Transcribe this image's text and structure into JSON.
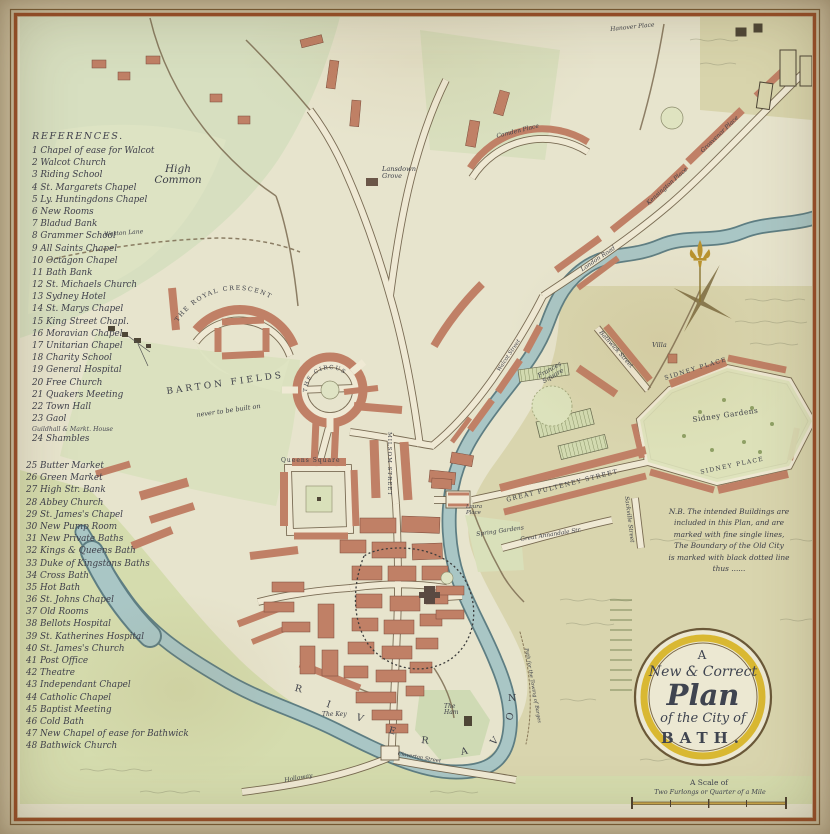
{
  "title_cartouche": {
    "word_a": "A",
    "line_new_correct": "New & Correct",
    "word_plan": "Plan",
    "line_city": "of the City of",
    "word_bath": "BATH."
  },
  "scale": {
    "caption": "A Scale of",
    "subcaption": "Two Furlongs or Quarter of a Mile"
  },
  "note": {
    "text": "N.B. The intended Buildings are\nincluded in this Plan, and are\nmarked with fine single lines,\nThe Boundary of the Old City\nis marked with black dotted line\nthus ......"
  },
  "references": {
    "title": "REFERENCES.",
    "block1": [
      "1 Chapel of ease for Walcot",
      "2 Walcot Church",
      "3 Riding School",
      "4 St. Margarets Chapel",
      "5 Ly. Huntingdons Chapel",
      "6 New Rooms",
      "7 Bladud Bank",
      "8 Grammer School",
      "9 All Saints Chapel",
      "10 Octagon Chapel",
      "11 Bath Bank",
      "12 St. Michaels Church",
      "13 Sydney Hotel",
      "14 St. Marys Chapel",
      "15 King Street Chapl.",
      "16 Moravian Chapel",
      "17 Unitarian Chapel",
      "18 Charity School",
      "19 General Hospital",
      "20 Free Church",
      "21 Quakers Meeting",
      "22 Town Hall",
      "23 Gaol",
      "24 Shambles"
    ],
    "note23": "Guildhall & Markt. House",
    "block2": [
      "25 Butter Market",
      "26 Green Market",
      "27 High Str. Bank",
      "28 Abbey Church",
      "29 St. James's Chapel",
      "30 New Pump Room",
      "31 New Private Baths",
      "32 Kings & Queens Bath",
      "33 Duke of Kingstons Baths",
      "34 Cross Bath",
      "35 Hot Bath",
      "36 St. Johns Chapel",
      "37 Old Rooms",
      "38 Bellots Hospital",
      "39 St. Katherines Hospital",
      "40 St. James's Church",
      "41 Post Office",
      "42 Theatre",
      "43 Independant Chapel",
      "44 Catholic Chapel",
      "45 Baptist Meeting",
      "46 Cold Bath",
      "47 New Chapel of ease for Bathwick",
      "48 Bathwick Church"
    ]
  },
  "map_labels": {
    "high_common": "High\nCommon",
    "lansdown_grove": "Lansdown\nGrove",
    "weston_lane": "Weston Lane",
    "royal_crescent": "THE ROYAL CRESCENT",
    "the_circus": "THE CIRCUS",
    "barton_fields": "BARTON FIELDS",
    "barton_note": "never to be built on",
    "queens_square": "Queens Square",
    "milsom_street": "MILSOM STREET",
    "camden_place": "Camden Place",
    "london_road": "London Road",
    "walcot_street": "Walcot Street",
    "grosvenor_place": "Grosvenor Place",
    "kensington_place": "Kensington Place",
    "hanover_place": "Hanover Place",
    "villa": "Villa",
    "bathwick_street": "Bathwick Street",
    "frances_square": "Frances\nSquare",
    "sidney_place_upper": "SIDNEY PLACE",
    "sidney_gardens": "Sidney Gardens",
    "sidney_place_lower": "SIDNEY PLACE",
    "great_pulteney": "GREAT PULTENEY STREET",
    "laura_place": "Laura\nPlace",
    "spring_gardens": "Spring Gardens",
    "annandale_street": "Great Annandale Str.",
    "sackville_street": "Sackville Street",
    "the_key": "The Key",
    "the_ham": "The\nHam",
    "holloway": "Holloway",
    "claverton_street": "Claverton Street",
    "towing_path": "Path for the Towing of Barges",
    "river_letters": [
      "R",
      "I",
      "V",
      "E",
      "R",
      "A",
      "V",
      "O",
      "N"
    ]
  },
  "colors": {
    "paper": "#cec1a1",
    "map_base": "#e7e4cd",
    "field_green": "#d8dfc0",
    "field_khaki": "#dad6b0",
    "building_salmon": "#c08066",
    "river_blue": "#a9c6c5",
    "ring_yellow": "#d9b832",
    "border_red": "#9a4e28",
    "ink": "#3e4049"
  }
}
